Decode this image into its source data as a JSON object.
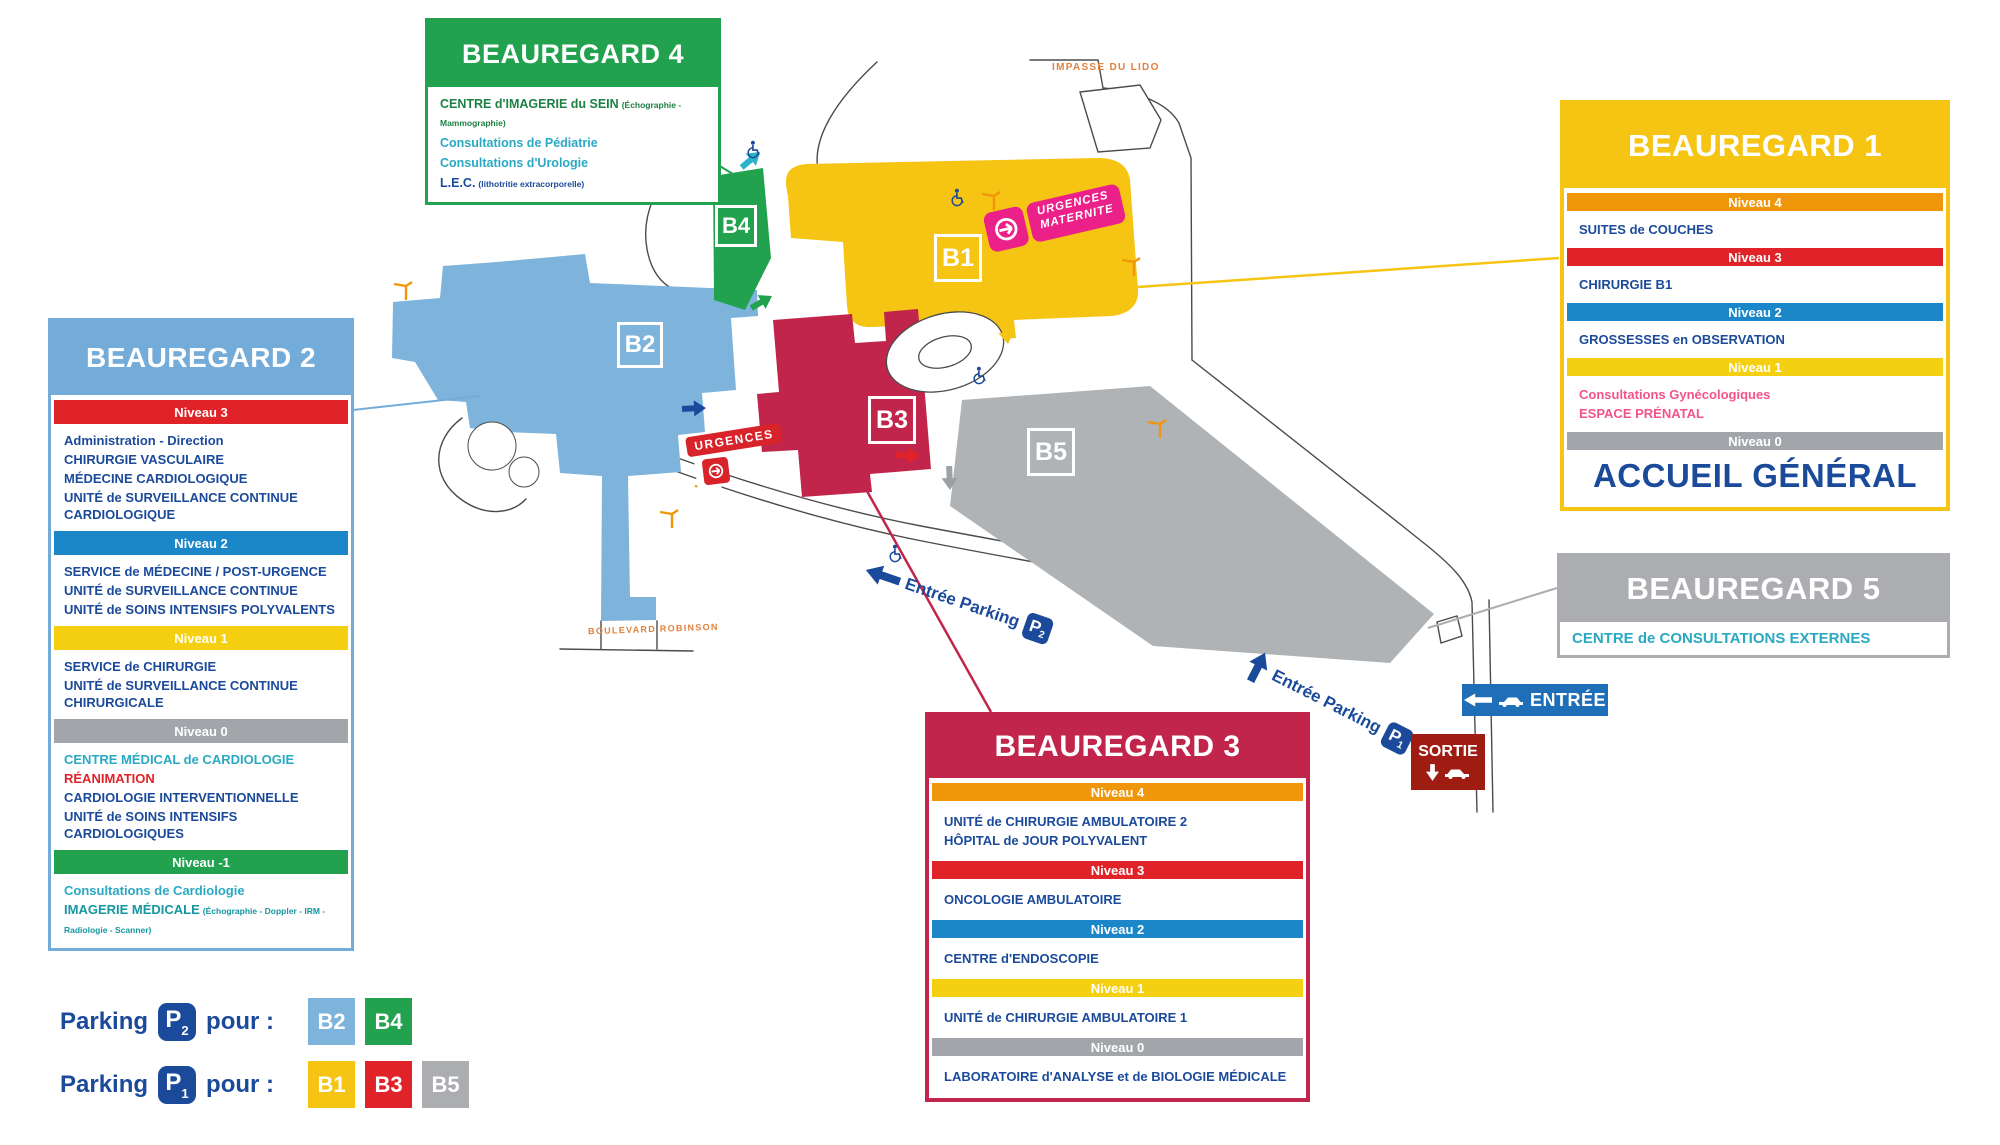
{
  "colors": {
    "navy": "#1B4A9B",
    "teal": "#29A9C2",
    "pink": "#F2548A",
    "red": "#E02328",
    "dark_green": "#1D8044",
    "dark_teal": "#1596A0",
    "band_niveau4": "#F0960B",
    "band_niveau3": "#E02328",
    "band_niveau2": "#1B87C8",
    "band_niveau1": "#F5D010",
    "band_niveau0": "#A2A6AA",
    "band_niveau_minus1": "#22A14F",
    "building_b1": "#F6C413",
    "building_b2": "#7EB3DC",
    "building_b3": "#C2254C",
    "building_b4": "#22A14F",
    "building_b5": "#B0B3B6",
    "entree_sign": "#1F6EB8",
    "sortie_sign": "#9E1C12",
    "urgences": "#D8232A",
    "maternite": "#EC2089",
    "street": "#E0813C"
  },
  "panels": {
    "b4": {
      "title": "BEAUREGARD 4",
      "items": [
        {
          "text": "CENTRE d'IMAGERIE du SEIN",
          "suffix": "(Échographie - Mammographie)"
        },
        {
          "text": "Consultations de Pédiatrie"
        },
        {
          "text": "Consultations d'Urologie"
        },
        {
          "text": "L.E.C.",
          "suffix": "(lithotritie extracorporelle)"
        }
      ]
    },
    "b2": {
      "title": "BEAUREGARD 2",
      "levels": [
        {
          "label": "Niveau 3",
          "items": [
            {
              "text": "Administration - Direction"
            },
            {
              "text": "CHIRURGIE VASCULAIRE"
            },
            {
              "text": "MÉDECINE CARDIOLOGIQUE"
            },
            {
              "text": "UNITÉ de SURVEILLANCE CONTINUE CARDIOLOGIQUE"
            }
          ]
        },
        {
          "label": "Niveau 2",
          "items": [
            {
              "text": "SERVICE de MÉDECINE / POST-URGENCE"
            },
            {
              "text": "UNITÉ de SURVEILLANCE CONTINUE"
            },
            {
              "text": "UNITÉ de SOINS INTENSIFS POLYVALENTS"
            }
          ]
        },
        {
          "label": "Niveau 1",
          "items": [
            {
              "text": "SERVICE de CHIRURGIE"
            },
            {
              "text": "UNITÉ de SURVEILLANCE CONTINUE CHIRURGICALE"
            }
          ]
        },
        {
          "label": "Niveau 0",
          "items": [
            {
              "text": "CENTRE MÉDICAL de CARDIOLOGIE"
            },
            {
              "text": "RÉANIMATION"
            },
            {
              "text": "CARDIOLOGIE INTERVENTIONNELLE"
            },
            {
              "text": "UNITÉ de SOINS INTENSIFS CARDIOLOGIQUES"
            }
          ]
        },
        {
          "label": "Niveau -1",
          "items": [
            {
              "text": "Consultations de Cardiologie"
            },
            {
              "text": "IMAGERIE MÉDICALE",
              "suffix": "(Échographie - Doppler - IRM - Radiologie - Scanner)"
            }
          ]
        }
      ]
    },
    "b1": {
      "title": "BEAUREGARD 1",
      "levels": [
        {
          "label": "Niveau 4",
          "items": [
            {
              "text": "SUITES de COUCHES"
            }
          ]
        },
        {
          "label": "Niveau 3",
          "items": [
            {
              "text": "CHIRURGIE B1"
            }
          ]
        },
        {
          "label": "Niveau 2",
          "items": [
            {
              "text": "GROSSESSES en OBSERVATION"
            }
          ]
        },
        {
          "label": "Niveau 1",
          "items": [
            {
              "text": "Consultations Gynécologiques"
            },
            {
              "text": "ESPACE PRÉNATAL"
            }
          ]
        },
        {
          "label": "Niveau 0",
          "items": [
            {
              "text": "ACCUEIL GÉNÉRAL"
            }
          ]
        }
      ]
    },
    "b5": {
      "title": "BEAUREGARD 5",
      "items": [
        {
          "text": "CENTRE de CONSULTATIONS EXTERNES"
        }
      ]
    },
    "b3": {
      "title": "BEAUREGARD 3",
      "levels": [
        {
          "label": "Niveau 4",
          "items": [
            {
              "text": "UNITÉ de CHIRURGIE AMBULATOIRE 2"
            },
            {
              "text": "HÔPITAL de JOUR POLYVALENT"
            }
          ]
        },
        {
          "label": "Niveau 3",
          "items": [
            {
              "text": "ONCOLOGIE AMBULATOIRE"
            }
          ]
        },
        {
          "label": "Niveau 2",
          "items": [
            {
              "text": "CENTRE d'ENDOSCOPIE"
            }
          ]
        },
        {
          "label": "Niveau 1",
          "items": [
            {
              "text": "UNITÉ de CHIRURGIE AMBULATOIRE 1"
            }
          ]
        },
        {
          "label": "Niveau 0",
          "items": [
            {
              "text": "LABORATOIRE d'ANALYSE et de BIOLOGIE MÉDICALE"
            }
          ]
        }
      ]
    }
  },
  "legend": {
    "rows": [
      {
        "label": "Parking",
        "badge_p": "P",
        "badge_sub": "2",
        "pour": "pour :",
        "chips": [
          {
            "text": "B2"
          },
          {
            "text": "B4"
          }
        ]
      },
      {
        "label": "Parking",
        "badge_p": "P",
        "badge_sub": "1",
        "pour": "pour :",
        "chips": [
          {
            "text": "B1"
          },
          {
            "text": "B3"
          },
          {
            "text": "B5"
          }
        ]
      }
    ]
  },
  "map": {
    "buildings": {
      "b1": "B1",
      "b2": "B2",
      "b3": "B3",
      "b4": "B4",
      "b5": "B5"
    },
    "badges": {
      "urgences": "URGENCES",
      "maternite_line1": "URGENCES",
      "maternite_line2": "MATERNITE",
      "parking2_text": "Entrée Parking",
      "parking2_p": "P",
      "parking2_sub": "2",
      "parking1_text": "Entrée Parking",
      "parking1_p": "P",
      "parking1_sub": "1",
      "entree": "ENTRÉE",
      "sortie": "SORTIE"
    },
    "streets": {
      "impasse": "IMPASSE DU LIDO",
      "boulevard": "BOULEVARD ROBINSON"
    }
  }
}
